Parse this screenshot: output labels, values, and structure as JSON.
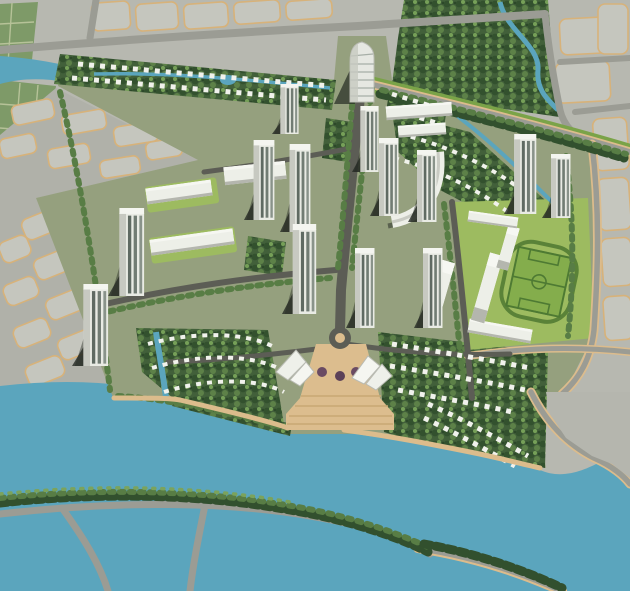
{
  "image_title": "Aerial rendering of a riverside urban master plan",
  "scene": {
    "description": "Bird's-eye architectural rendering of a planned mixed-use community bounded by rivers, with high-rise towers along a central boulevard, villa rows, a school campus with soccer field, waterfront plaza, tree-lined streets, surrounding farmland and vacant parcels",
    "features": [
      "north-river",
      "north-villa-band",
      "northeast-forest",
      "northeast-creek",
      "west-parcel-grid",
      "northeast-parcel-grid",
      "farmland",
      "central-boulevard",
      "roundabout",
      "waterfront-plaza",
      "pavilions",
      "landmark-tower",
      "tower-clusters",
      "arc-building",
      "school-campus",
      "soccer-field",
      "villa-crescents",
      "south-river",
      "lake",
      "tree-lined-roads"
    ],
    "tower_count": 13,
    "water_bodies": 4
  },
  "palette": {
    "land": "#b7b8b0",
    "parcel": "#c5c6be",
    "parcelLine": "#d7b27a",
    "roadLight": "#9b9c94",
    "roadDark": "#5c5d55",
    "roadTan": "#dcbc8c",
    "water": "#5ba5bd",
    "farm": "#7e9a68",
    "devBase": "#95a07e",
    "lawn": "#9dbb60",
    "field": "#84ad4c",
    "fieldLine": "#4e7a33",
    "treeDark": "#32502e",
    "treeMid": "#587d45",
    "treeLight": "#7ba35c",
    "building": "#eceee7",
    "buildingShade": "#c7c9c1",
    "plaza": "#dcbd8e",
    "plazaLine": "#c8a873",
    "shadow": "#252b24"
  }
}
